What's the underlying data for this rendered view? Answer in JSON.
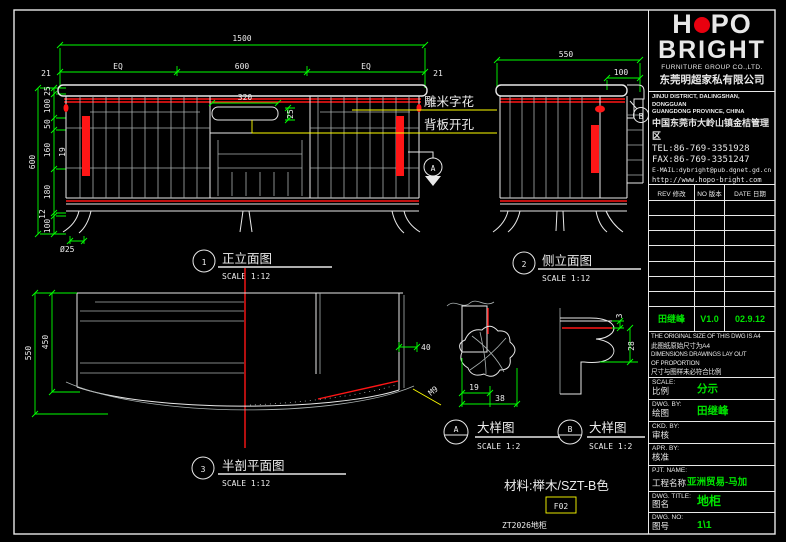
{
  "tb": {
    "logo_h": "H",
    "logo_po": "PO",
    "logo_bright": "BRIGHT",
    "group": "FURNITURE GROUP CO.,LTD.",
    "company_cn": "东莞明超家私有限公司",
    "addr": [
      "JINJU DISTRICT, DALINGSHAN, DONGGUAN",
      "GUANGDONG PROVINCE, CHINA",
      "中国东莞市大岭山镇金桔管理区",
      "TEL:86-769-3351928",
      "FAX:86-769-3351247",
      "E-MAIL:dybright@pub.dgnet.gd.cn",
      "http://www.hopo-bright.com"
    ],
    "rev_headers": [
      "REV 修改",
      "NO 版本",
      "DATE 日期"
    ],
    "rev_entry": {
      "name": "田继峰",
      "ver": "V1.0",
      "date": "02.9.12"
    },
    "disclaimer": [
      "THE ORIGINAL SIZE OF THIS DWG IS A4",
      "此图纸原始尺寸为A4",
      "DIMENSIONS DRAWINGS LAY OUT",
      "OF PROPORTION",
      "尺寸与图样未必符合比例"
    ],
    "fields": [
      {
        "en": "SCALE:",
        "cn": "比例",
        "val": "分示"
      },
      {
        "en": "DWG. BY:",
        "cn": "绘图",
        "val": "田继峰"
      },
      {
        "en": "CKD. BY:",
        "cn": "审核",
        "val": ""
      },
      {
        "en": "APR. BY:",
        "cn": "核准",
        "val": ""
      },
      {
        "en": "PJT. NAME:",
        "cn": "工程名称",
        "val": "亚洲贸易-马加"
      },
      {
        "en": "DWG. TITLE:",
        "cn": "图名",
        "val": "地柜"
      },
      {
        "en": "DWG. NO:",
        "cn": "图号",
        "val": "1\\1"
      }
    ]
  },
  "views": {
    "front": {
      "num": "1",
      "title": "正立面图",
      "scale": "SCALE 1:12"
    },
    "side": {
      "num": "2",
      "title": "侧立面图",
      "scale": "SCALE 1:12"
    },
    "plan": {
      "num": "3",
      "title": "半剖平面图",
      "scale": "SCALE 1:12"
    },
    "da": {
      "num": "A",
      "title": "大样图",
      "scale": "SCALE 1:2"
    },
    "db": {
      "num": "B",
      "title": "大样图",
      "scale": "SCALE 1:2"
    }
  },
  "balloons": {
    "a": "A",
    "b": "B"
  },
  "dims": {
    "front": {
      "w": "1500",
      "eq1": "EQ",
      "mid": "600",
      "eq2": "EQ",
      "end1": "21",
      "end2": "21",
      "slot_w": "320",
      "slot_h": "25",
      "h": "600",
      "c1": "25",
      "c2": "100",
      "c3": "50",
      "c4": "160",
      "c5": "180",
      "c6": "12",
      "c7": "100",
      "k19": "19",
      "leg": "Ø25"
    },
    "side": {
      "w": "550",
      "ov": "100"
    },
    "plan": {
      "d": "550",
      "di": "450",
      "t": "40",
      "note": "M9"
    },
    "da": {
      "a": "19",
      "b": "38"
    },
    "db": {
      "a": "3",
      "b": "28"
    }
  },
  "notes": {
    "n1": "雕米字花",
    "n2": "背板开孔",
    "material": "材料:榉木/SZT-B色",
    "code": "F02",
    "product": "ZT2026地柜"
  },
  "colors": {
    "dim_green": "#00ff00",
    "value_green": "#00e400",
    "accent_red": "#ff1616",
    "annot_yellow": "#ffff00",
    "logo_red": "#e8000f",
    "line_white": "#e8e8e8"
  }
}
